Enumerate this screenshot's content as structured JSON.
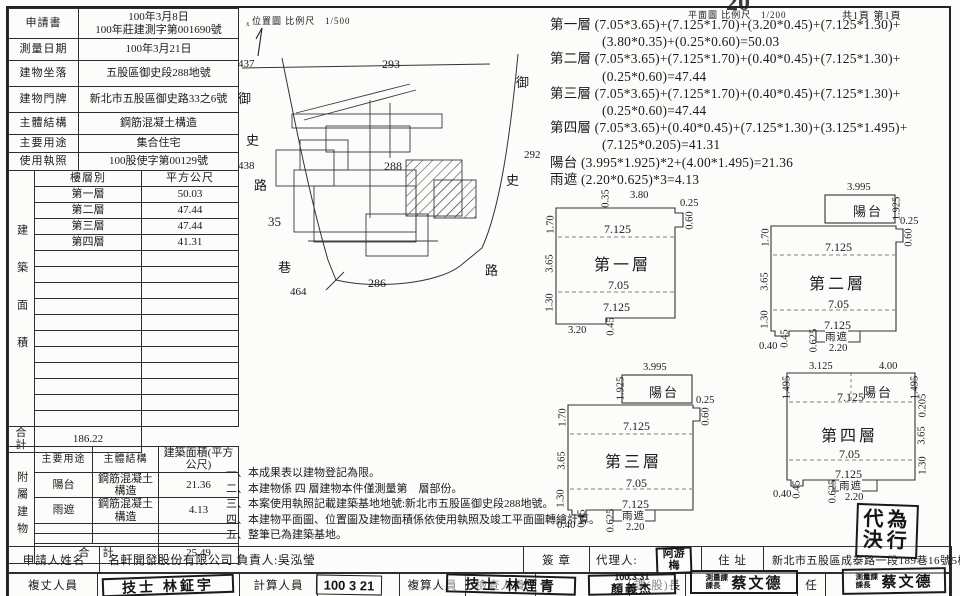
{
  "page": {
    "location_map_label": "位置圖 比例尺",
    "location_map_scale": "1/500",
    "floor_plan_label": "平面圖 比例尺",
    "floor_plan_scale": "1/200",
    "page_count": "共1頁 第1頁",
    "top_edge_note": "20"
  },
  "info": {
    "rows": [
      {
        "label": "申請書",
        "value": "100年3月8日",
        "value2": "100年莊建測字第001690號"
      },
      {
        "label": "測量日期",
        "value": "100年3月21日"
      },
      {
        "label": "建物坐落",
        "value": "五股區御史段288地號"
      },
      {
        "label": "建物門牌",
        "value": "新北市五股區御史路33之6號"
      },
      {
        "label": "主體結構",
        "value": "鋼筋混凝土構造"
      },
      {
        "label": "主要用途",
        "value": "集合住宅"
      },
      {
        "label": "使用執照",
        "value": "100股使字第00129號"
      }
    ]
  },
  "building": {
    "side": "建築面積",
    "h1": "樓層別",
    "h2": "平方公尺",
    "rows": [
      {
        "f": "第一層",
        "a": "50.03"
      },
      {
        "f": "第二層",
        "a": "47.44"
      },
      {
        "f": "第三層",
        "a": "47.44"
      },
      {
        "f": "第四層",
        "a": "41.31"
      }
    ],
    "total_label": "合　計",
    "total": "186.22"
  },
  "attached": {
    "side": "附屬建物",
    "h1": "主要用途",
    "h2": "主體結構",
    "h3": "建築面積(平方公尺)",
    "rows": [
      {
        "u": "陽台",
        "s": "鋼筋混凝土構造",
        "a": "21.36"
      },
      {
        "u": "雨遮",
        "s": "鋼筋混凝土構造",
        "a": "4.13"
      }
    ],
    "total_label": "合　計",
    "total": "25.49"
  },
  "site": {
    "labels": {
      "n437": "437",
      "yu_l": "御",
      "shi_l": "史",
      "n438": "438",
      "lu_l": "路",
      "n35": "35",
      "xiang": "巷",
      "n464": "464",
      "n286": "286",
      "n288": "288",
      "n293": "293",
      "yu_r": "御",
      "shi_r": "史",
      "n292": "292",
      "lu_r": "路",
      "north": "x"
    }
  },
  "formulas": [
    "第一層 (7.05*3.65)+(7.125*1.70)+(3.20*0.45)+(7.125*1.30)+",
    "(3.80*0.35)+(0.25*0.60)=50.03",
    "第二層 (7.05*3.65)+(7.125*1.70)+(0.40*0.45)+(7.125*1.30)+",
    "(0.25*0.60)=47.44",
    "第三層 (7.05*3.65)+(7.125*1.70)+(0.40*0.45)+(7.125*1.30)+",
    "(0.25*0.60)=47.44",
    "第四層 (7.05*3.65)+(0.40*0.45)+(7.125*1.30)+(3.125*1.495)+",
    "(7.125*0.205)=41.31",
    "陽台 (3.995*1.925)*2+(4.00*1.495)=21.36",
    "雨遮 (2.20*0.625)*3=4.13"
  ],
  "plans": {
    "p1": {
      "title": "第一層",
      "d035": "0.35",
      "d380": "3.80",
      "d025": "0.25",
      "d060": "0.60",
      "d170": "1.70",
      "d365": "3.65",
      "d130": "1.30",
      "d7125a": "7.125",
      "d705": "7.05",
      "d7125b": "7.125",
      "d320": "3.20",
      "d045": "0.45"
    },
    "p2": {
      "title": "第二層",
      "balcony": "陽台",
      "canopy": "雨遮",
      "d3995": "3.995",
      "d1925": "1.925",
      "d025": "0.25",
      "d060": "0.60",
      "d170": "1.70",
      "d365": "3.65",
      "d130": "1.30",
      "d7125a": "7.125",
      "d705": "7.05",
      "d7125b": "7.125",
      "d040": "0.40",
      "d045": "0.45",
      "d0625": "0.625",
      "d220": "2.20"
    },
    "p3": {
      "title": "第三層",
      "balcony": "陽台",
      "canopy": "雨遮",
      "d3995": "3.995",
      "d1925": "1.925",
      "d025": "0.25",
      "d060": "0.60",
      "d170": "1.70",
      "d365": "3.65",
      "d130": "1.30",
      "d7125a": "7.125",
      "d705": "7.05",
      "d7125b": "7.125",
      "d040": "0.40",
      "d045": "0.45",
      "d0625": "0.625",
      "d220": "2.20"
    },
    "p4": {
      "title": "第四層",
      "balcony": "陽台",
      "canopy": "雨遮",
      "d3125": "3.125",
      "d400": "4.00",
      "d1495a": "1.495",
      "d1495b": "1.495",
      "d0205": "0.205",
      "d365": "3.65",
      "d130": "1.30",
      "d7125a": "7.125",
      "d705": "7.05",
      "d7125b": "7.125",
      "d040": "0.40",
      "d045": "0.45",
      "d0625": "0.625",
      "d220": "2.20"
    }
  },
  "notes": [
    "一、本成果表以建物登記為限。",
    "二、本建物係 四 層建物本件僅測量第　層部份。",
    "三、本案使用執照記載建築基地地號:新北市五股區御史段288地號。",
    "四、本建物平面圖、位置圖及建物面積係依使用執照及竣工平面圖轉繪計算。",
    "五、整筆已為建築基地。"
  ],
  "footer": {
    "applicant_label": "申請人姓名",
    "applicant": "名軒開發股份有限公司 負責人:吳泓瑩",
    "seal_label": "簽 章",
    "agent_label": "代理人:",
    "address_label": "住 址",
    "address": "新北市五股區成泰路一段189巷16號5樓",
    "surveyor_label": "複丈人員",
    "calculator_label": "計算人員",
    "checker_label": "複算人員",
    "inspector_label": "檢查人員",
    "chief_label": "課(股)長",
    "director_label": "任"
  },
  "stamps": {
    "surveyor": "技士 林鉦宇",
    "calc_date": "100 3 21",
    "calc_date2": "30",
    "checker": "技士 林煙青",
    "inspector_date": "100.3.31",
    "inspector": "顏義杰",
    "chief_title": "測量課課長",
    "chief": "蔡文德",
    "director_title": "測量課課長",
    "director": "蔡文德",
    "agent_line1": "阿游",
    "agent_line2": "梅",
    "proxy_line1": "代為",
    "proxy_line2": "決行"
  }
}
